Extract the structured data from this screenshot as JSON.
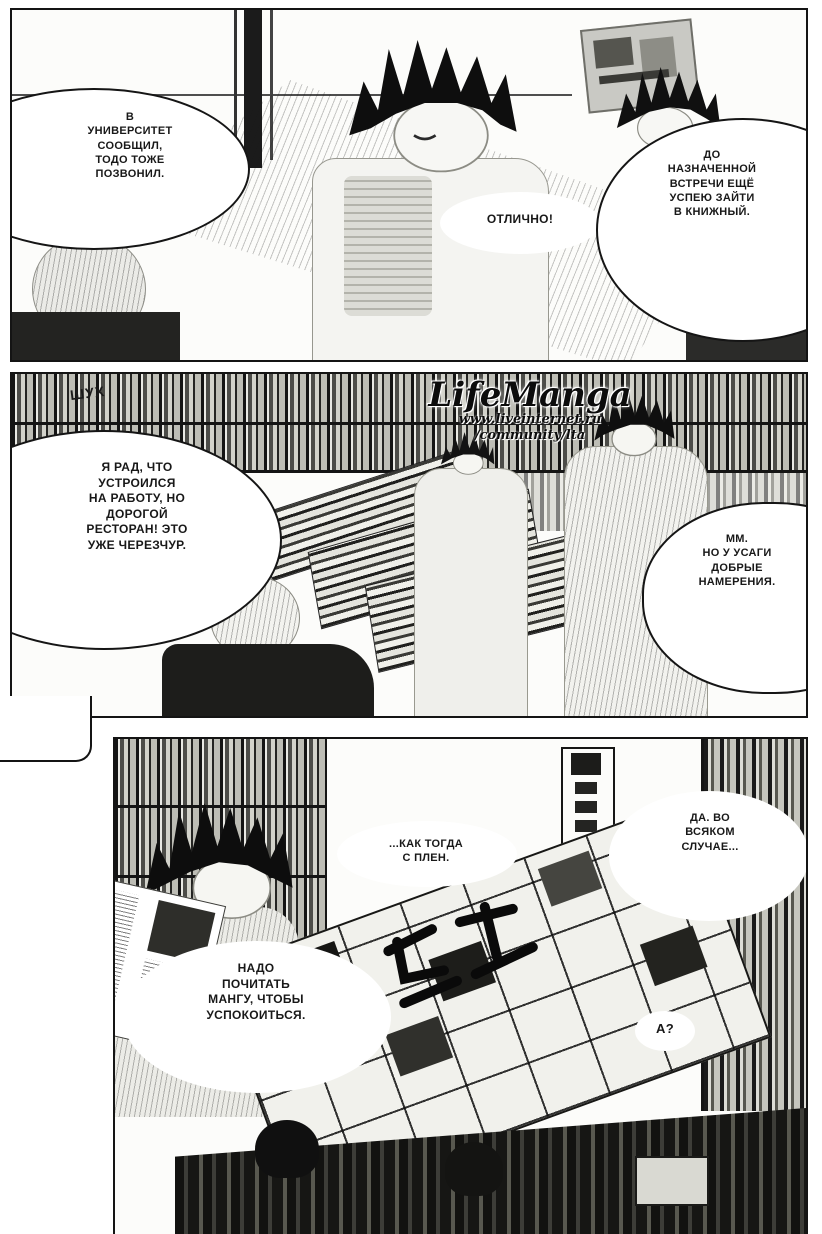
{
  "panel1": {
    "bubble_university": "В\nУНИВЕРСИТЕТ\nСООБЩИЛ,\nТОДО ТОЖЕ\nПОЗВОНИЛ.",
    "bubble_otlichno": "ОТЛИЧНО!",
    "bubble_bookstore": "ДО\nНАЗНАЧЕННОЙ\nВСТРЕЧИ ЕЩЁ\nУСПЕЮ ЗАЙТИ\nВ КНИЖНЫЙ."
  },
  "panel2": {
    "sfx": "ШУХ",
    "watermark": {
      "logo": "LifeManga",
      "line1": "www.liveinternet.ru",
      "line2": "/community/lta"
    },
    "bubble_job": "Я РАД, ЧТО\nУСТРОИЛСЯ\nНА РАБОТУ, НО\nДОРОГОЙ\nРЕСТОРАН! ЭТО\nУЖЕ ЧЕРЕЗЧУР.",
    "bubble_usagi": "ММ.\nНО У УСАГИ\nДОБРЫЕ\nНАМЕРЕНИЯ."
  },
  "panel3": {
    "text_recall": "...КАК ТОГДА\nС ПЛЕН.",
    "bubble_anyway": "ДА. ВО\nВСЯКОМ\nСЛУЧАЕ...",
    "bubble_read_manga": "НАДО\nПОЧИТАТЬ\nМАНГУ, ЧТОБЫ\nУСПОКОИТЬСЯ.",
    "text_huh": "А?"
  },
  "colors": {
    "ink": "#181818",
    "paper": "#fcfcfa"
  }
}
